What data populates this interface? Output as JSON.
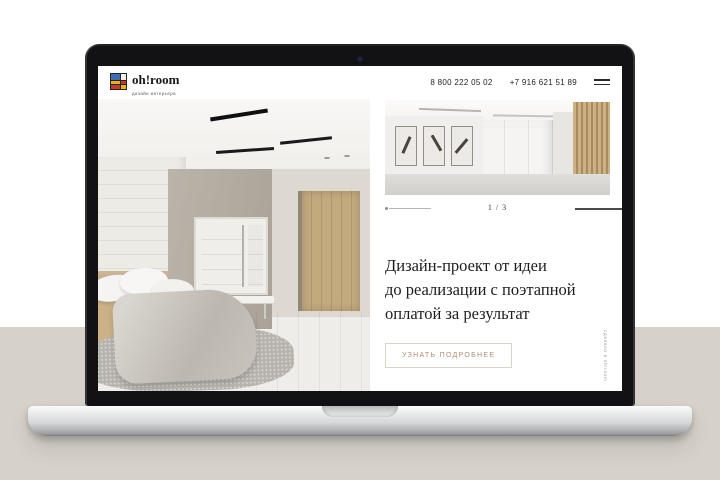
{
  "brand": {
    "name": "oh!room",
    "tagline": "дизайн интерьера",
    "colors": {
      "logo_blue": "#3a6fb5",
      "logo_red": "#c23a2c",
      "logo_yellow": "#e8b021",
      "accent": "#ab9071",
      "backdrop_bottom": "#d6d1c9"
    }
  },
  "header": {
    "phone_primary": "8 800 222 05 02",
    "phone_secondary": "+7 916 621 51 89"
  },
  "carousel": {
    "current": 1,
    "total": 3,
    "counter": "1 / 3"
  },
  "hero": {
    "heading_lines": [
      "Дизайн-проект от идеи",
      "до реализации с поэтапной",
      "оплатой за результат"
    ],
    "cta_label": "УЗНАТЬ ПОДРОБНЕЕ"
  },
  "footer": {
    "vertical_credit": "сделано в oh!room"
  }
}
